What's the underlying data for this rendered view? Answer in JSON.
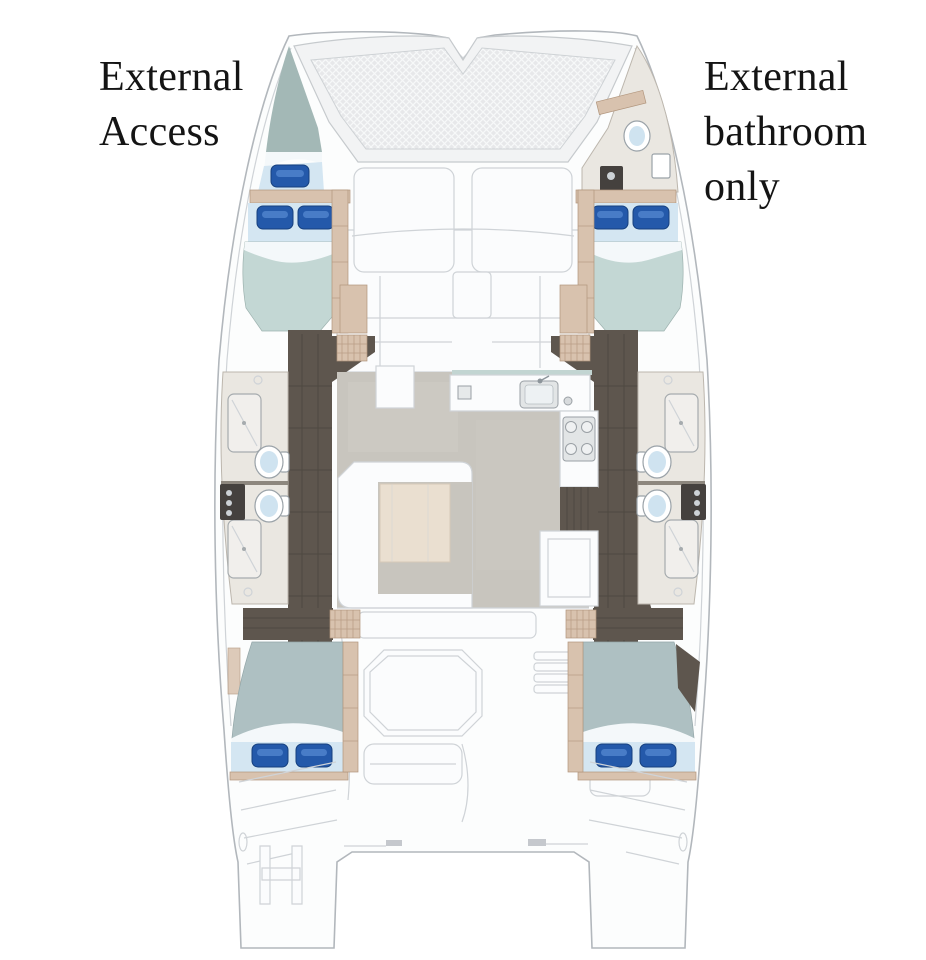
{
  "page": {
    "background": "#ffffff",
    "width": 926,
    "height": 960
  },
  "annotations": {
    "external_access": {
      "lines": [
        "External",
        "Access"
      ]
    },
    "external_bathroom": {
      "lines": [
        "External",
        "bathroom",
        "only"
      ]
    }
  },
  "palette": {
    "page_bg": "#ffffff",
    "hull_fill": "#fcfdfd",
    "hull_stroke": "#b2b7bc",
    "panel_line": "#cfd3d7",
    "mesh_base": "#e7e8ea",
    "forepeak": "#a3b8b6",
    "duvet": "#c3d7d4",
    "duvet_aft": "#aec0c2",
    "sheet": "#d4e6f2",
    "pillow": "#2459aa",
    "pillow_dark": "#16407e",
    "pillow_hi": "#4f83cc",
    "wood": "#5e564e",
    "wood_line": "#453f39",
    "trim_tan": "#d8c2ae",
    "trim_line": "#b1957c",
    "bath_floor": "#eae7e1",
    "fixture_dark": "#45413e",
    "toilet_bowl": "#cfe3f0",
    "saloon_floor": "#c8c5be",
    "table_top": "#eadfd0",
    "glass": "#c2d5d2"
  }
}
